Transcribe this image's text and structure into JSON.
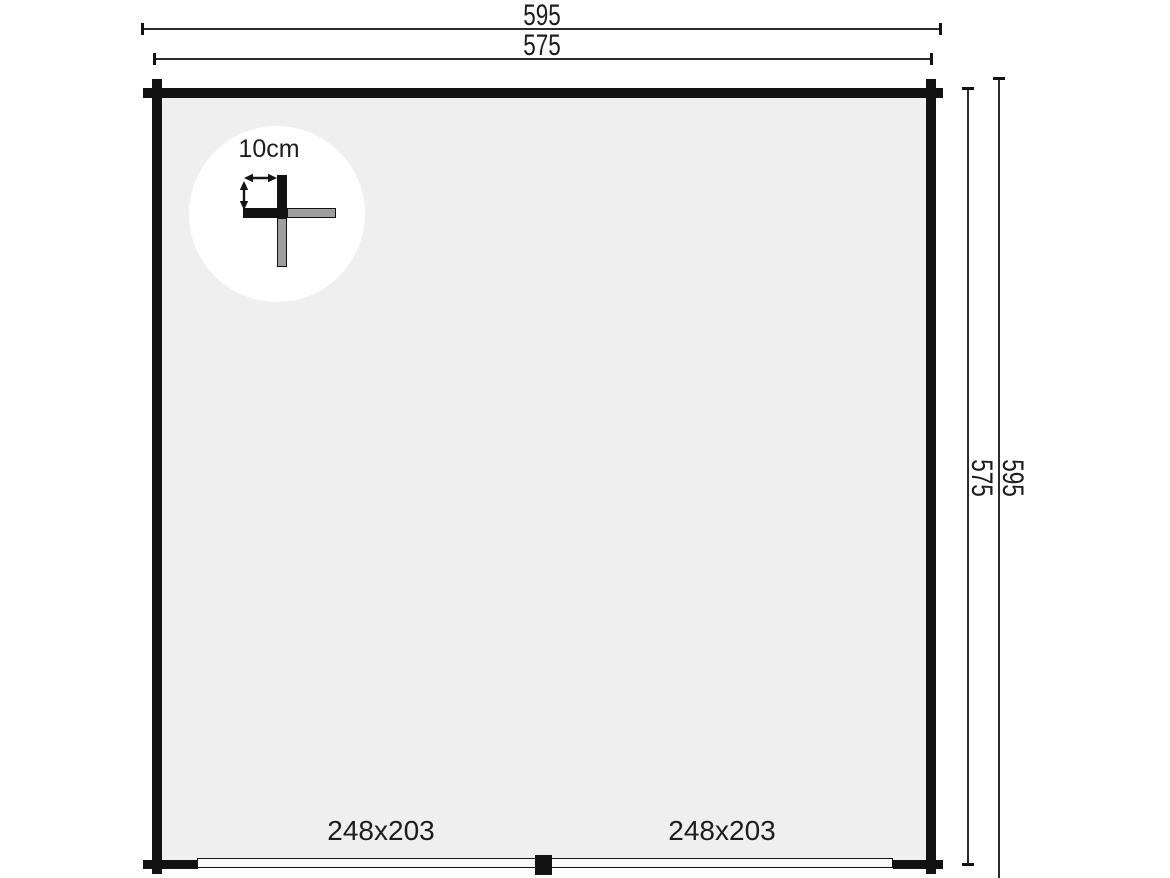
{
  "drawing": {
    "type": "floor-plan",
    "dimensions": {
      "top_outer": "595",
      "top_inner": "575",
      "right_inner": "575",
      "right_outer": "595"
    },
    "doors": [
      {
        "label": "248x203"
      },
      {
        "label": "248x203"
      }
    ],
    "corner_detail": {
      "label": "10cm"
    },
    "colors": {
      "background": "#ffffff",
      "interior": "#efefef",
      "wall": "#121212",
      "dimension_line": "#2b2b2b",
      "log_end_gray": "#9e9e9e",
      "door_sill": "#f9f9f9",
      "text": "#1d1d1d"
    }
  }
}
